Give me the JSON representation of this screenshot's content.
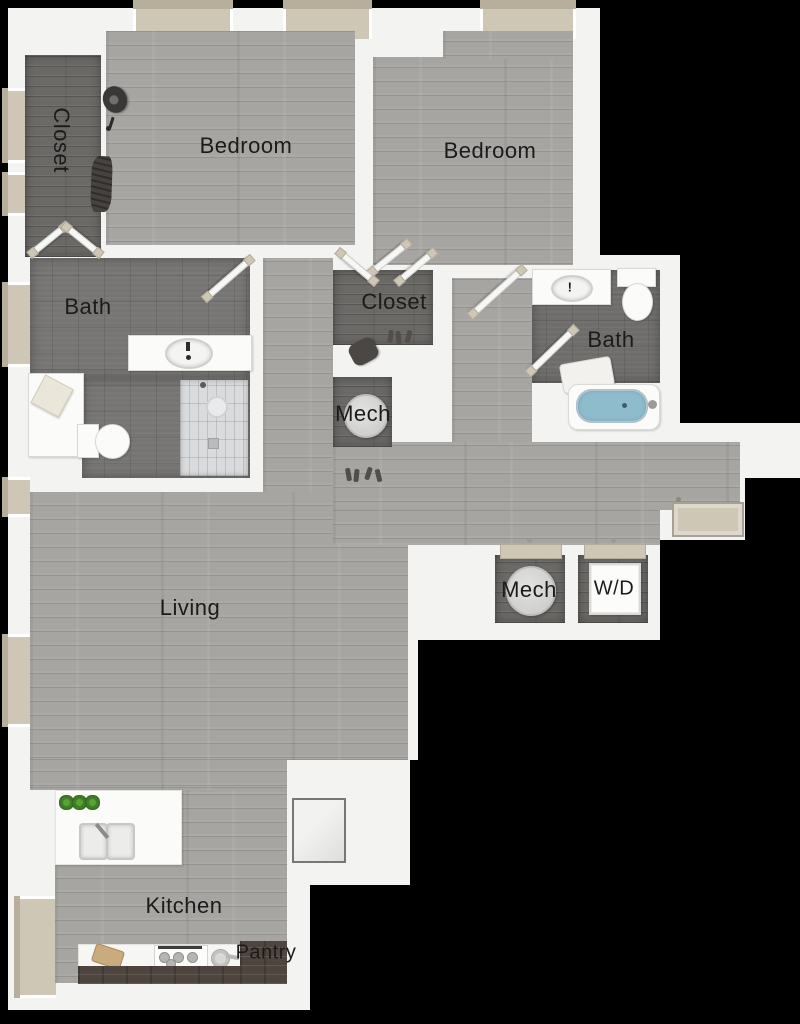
{
  "palette": {
    "background": "#000000",
    "wall": "#f3f3f1",
    "wood_floor": "#a6a5a2",
    "dark_tile": "#777573",
    "dark_tile_bath2": "#6f6d6b",
    "dark_wood": "#6b6966",
    "window_beige": "#cfc7b5",
    "window_beige_dark": "#b7ae9c",
    "shower_tile": "#d9dbdd",
    "tub_water": "#8fbccd",
    "plant_green": "#4e9130",
    "pantry_wood": "#4e463e",
    "label_color": "#1b1b1b"
  },
  "rooms": {
    "closet_entry": {
      "label": "Closet"
    },
    "bedroom_left": {
      "label": "Bedroom"
    },
    "bedroom_right": {
      "label": "Bedroom"
    },
    "bath_main": {
      "label": "Bath"
    },
    "closet_hall": {
      "label": "Closet"
    },
    "mech_hall": {
      "label": "Mech"
    },
    "bath_second": {
      "label": "Bath"
    },
    "living": {
      "label": "Living"
    },
    "mech_laundry": {
      "label": "Mech"
    },
    "washer_dryer": {
      "label": "W/D"
    },
    "kitchen": {
      "label": "Kitchen"
    },
    "pantry": {
      "label": "Pantry"
    }
  },
  "marks": {
    "bath2_sink": "!"
  },
  "fixtures": [
    "hat",
    "hanging-clothes",
    "hook",
    "double-doors",
    "door-leaf",
    "vanity-sink",
    "toilet",
    "walk-in-shower",
    "bench-paper",
    "shoes",
    "bag",
    "water-heater",
    "washer-dryer-unit",
    "bathtub",
    "towel",
    "kitchen-island",
    "double-sink",
    "potted-plants",
    "cutting-board",
    "range-stove",
    "pan",
    "pantry-shelves",
    "entry-door",
    "balcony-door",
    "window-bay"
  ]
}
